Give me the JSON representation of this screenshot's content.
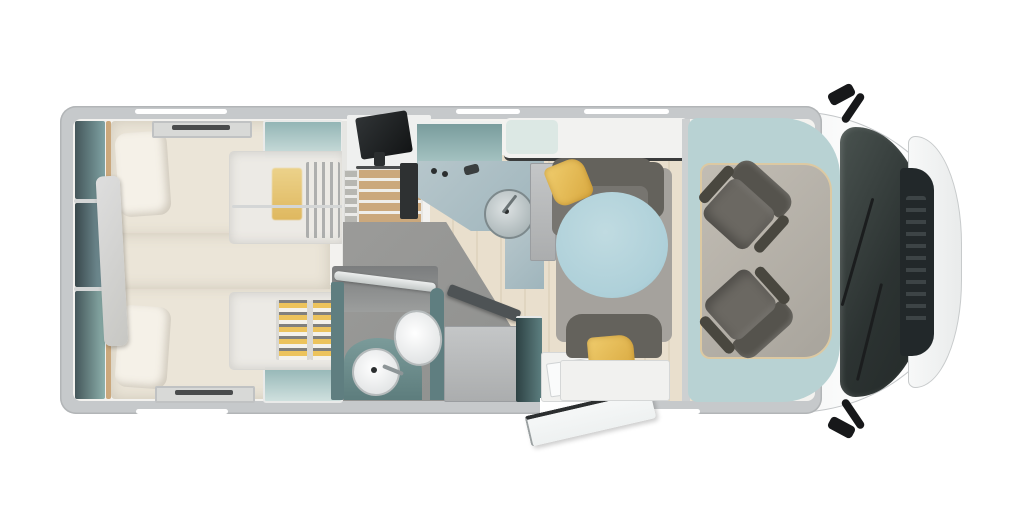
{
  "scene": {
    "type": "motorhome floor plan, top-down 3D render",
    "orientation": "cab on right, rear bedroom on left, entry door open at bottom",
    "areas": [
      {
        "label": "rear twin bedroom with two single beds, pillows, rear wall shelving and headboard divider"
      },
      {
        "label": "his-and-hers wardrobes with folded clothes and hangers"
      },
      {
        "label": "steps with TV leading to rear beds"
      },
      {
        "label": "kitchen with L-shaped worktop, round sink, hob and overhead locker"
      },
      {
        "label": "bathroom with shower, toilet and round basin on vanity"
      },
      {
        "label": "entry door shown swung open with step"
      },
      {
        "label": "dinette with round pedestal table, bench seats and yellow cushions"
      },
      {
        "label": "cab with two swivelled captain seats, windscreen, bonnet and wing mirrors"
      }
    ]
  },
  "colors": {
    "bg": "#ffffff",
    "wall": "#c6c9cb",
    "wall-edge": "#b2b5b7",
    "interior": "#f3f2ef",
    "white-trim": "#ffffff",
    "shelf-teal": "#7fa2a3",
    "shelf-dark": "#44565a",
    "teal-light": "#a9c6c5",
    "teal-pale": "#cfe0de",
    "teal-cab": "#5f7e80",
    "teal-deep": "#3e5a5c",
    "band": "#b8d2d3",
    "counter": "#9fb5bc",
    "bed": "#ebe5d8",
    "pillow": "#f5f1e8",
    "wood": "#cba87c",
    "wood-light": "#e9dfcd",
    "floor-gray": "#8f908e",
    "rug": "#a5a29d",
    "bench": "#777570",
    "bench-dark": "#64625c",
    "seat": "#6b6862",
    "table": "#aed0d9",
    "yellow": "#ecc35c",
    "yellow-deep": "#d9a940",
    "dark": "#1d1f20",
    "glass": "#343b39",
    "door": "#eef1f1",
    "trim-tan": "#dcc9a2"
  }
}
